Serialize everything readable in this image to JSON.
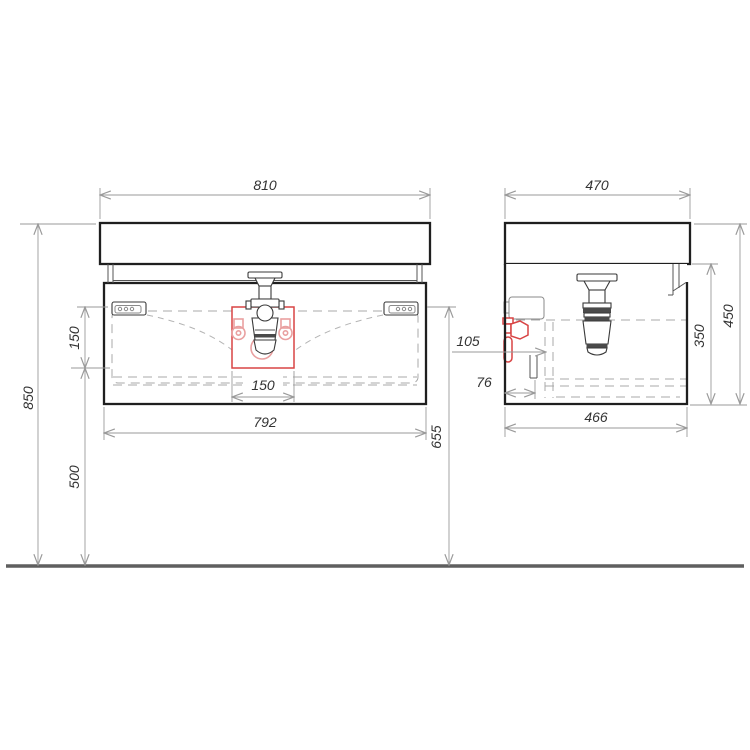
{
  "front": {
    "top_width": "810",
    "overall_height": "850",
    "hinge_offset": "150",
    "lower_height": "500",
    "drain_width": "150",
    "body_width": "792",
    "rail_height": "655"
  },
  "side": {
    "top_depth": "470",
    "overall_height": "450",
    "body_height": "350",
    "body_depth": "466",
    "drawer_back_offset": "105",
    "rail_back_offset": "76"
  },
  "colors": {
    "outline": "#1f1f1f",
    "detail": "#3a3a3a",
    "detail_light": "#8a8a8a",
    "dimension": "#9a9a9a",
    "dim_text": "#333333",
    "accent_red": "#d84444",
    "accent_red_light": "#e9a0a0",
    "floor": "#5f5f5f",
    "background": "#ffffff"
  }
}
